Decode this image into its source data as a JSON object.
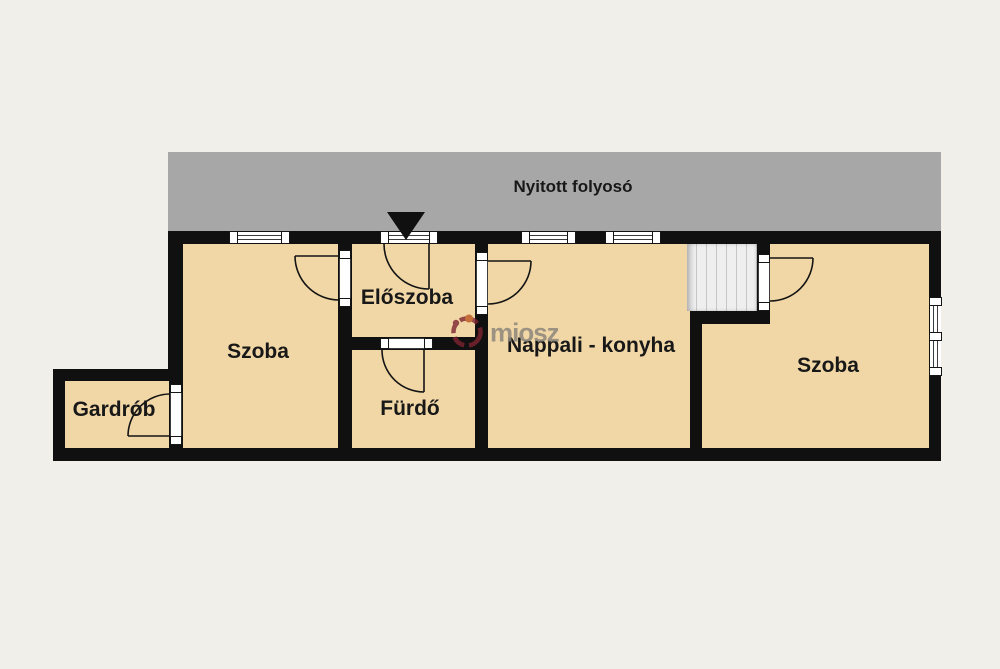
{
  "plan": {
    "colors": {
      "page_bg": "#f1efe9",
      "wall": "#101010",
      "room_fill": "#f2d7a6",
      "corridor_fill": "#a7a7a7",
      "stairs_fill": "#efefef",
      "window_fill": "#ffffff",
      "label_color": "#181818",
      "watermark_text_color": "#8d867c",
      "watermark_logo_color": "#7d2430"
    },
    "corridor": {
      "label": "Nyitott folyosó"
    },
    "rooms": [
      {
        "id": "szoba-left",
        "label": "Szoba"
      },
      {
        "id": "eloszoba",
        "label": "Előszoba"
      },
      {
        "id": "furdo",
        "label": "Fürdő"
      },
      {
        "id": "nappali-konyha",
        "label": "Nappali - konyha"
      },
      {
        "id": "szoba-right",
        "label": "Szoba"
      },
      {
        "id": "gardrob",
        "label": "Gardrób"
      }
    ],
    "watermark": {
      "text": "miosz"
    }
  }
}
